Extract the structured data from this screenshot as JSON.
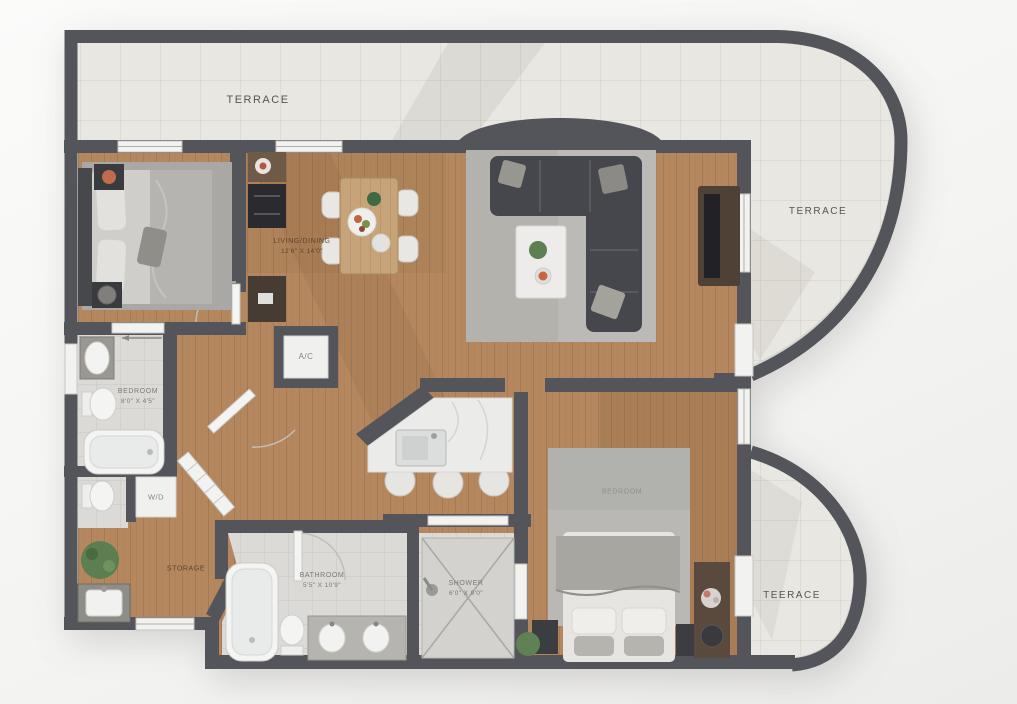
{
  "floor_plan": {
    "type": "apartment floor plan with terraces",
    "rooms": {
      "terrace_top": {
        "label": "TERRACE"
      },
      "terrace_right": {
        "label": "TERRACE"
      },
      "terrace_bottom": {
        "label": "TEERACE"
      },
      "living_dining": {
        "label": "LIVING/DINING",
        "dims": "12'6\" X 14'0\""
      },
      "bathroom_main": {
        "label": "BEDROOM",
        "dims": "8'0\" X 4'5\""
      },
      "ac_closet": {
        "label": "A/C"
      },
      "laundry_closet": {
        "label": "W/D"
      },
      "hall": {
        "label": "STORAGE"
      },
      "bathroom_2": {
        "label": "BATHROOM",
        "dims": "5'5\" X 10'9\""
      },
      "shower_room": {
        "label": "SHOWER",
        "dims": "6'0\" X 9'0\""
      },
      "bedroom_2": {
        "label": "BEDROOM"
      }
    },
    "colors": {
      "wall": "#54555b",
      "wood_floor": "#b4875e",
      "terrace_tile": "#e9e7e2",
      "bath_tile": "#dbdad6",
      "rug": "#bcbab6",
      "sofa": "#46474c",
      "marble_counter": "#ebebea",
      "plant_green": "#5c7e50",
      "flower_accent": "#c06a4e"
    }
  }
}
